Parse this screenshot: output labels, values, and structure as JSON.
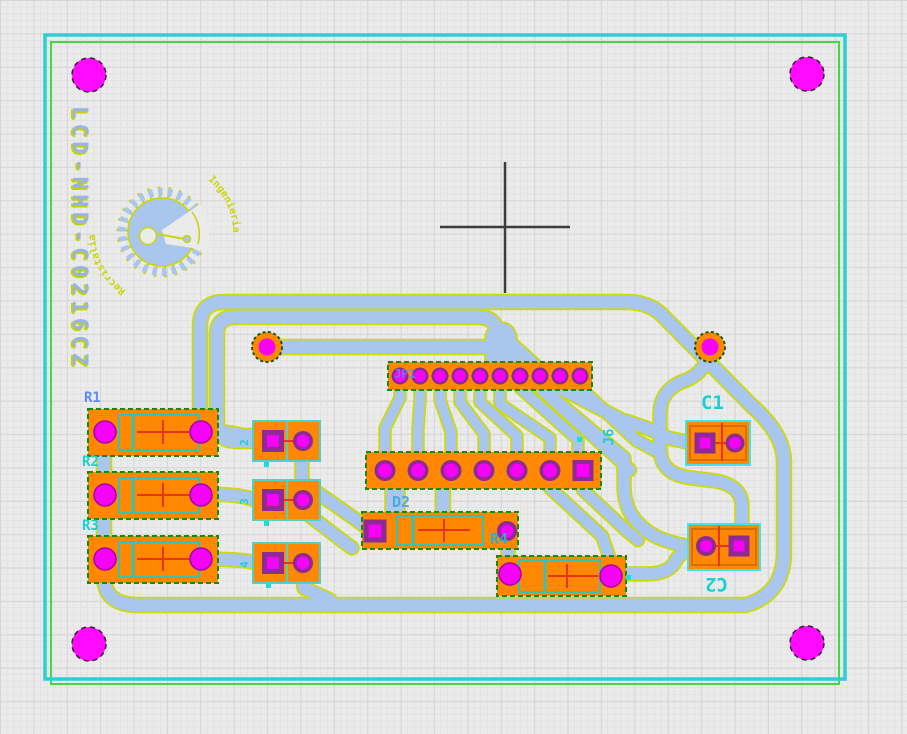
{
  "app": {
    "view": "pcb-board-editor-canvas"
  },
  "board_title": "LCD-NHD-C0216CZ",
  "labels": {
    "r1": "R1",
    "r2": "R2",
    "r3": "R3",
    "r4": "R4",
    "c1": "C1",
    "c2": "C2",
    "d2": "D2",
    "jp1": "JP1",
    "j6": "J6",
    "jumper1": "2",
    "jumper2": "3",
    "jumper3": "4"
  },
  "logo": {
    "arc_left": "Recristalia",
    "arc_right": "Ingenieria"
  },
  "colors": {
    "background": "#ebebeb",
    "board_outline": "#2ccfd4",
    "board_outline_inner": "#3fdc3f",
    "trace": "#a9c6ef",
    "trace_fringe": "#cdda05",
    "pad_copper": "#ff8800",
    "pad_ring": "#8e2a94",
    "drill": "#f403f4",
    "mount_hole": "#ff09ff",
    "silkscreen_red": "#e8341c",
    "label_cyan": "#1ad0d0",
    "label_blue": "#5e8cf5",
    "crosshair": "#3c3c3c"
  }
}
